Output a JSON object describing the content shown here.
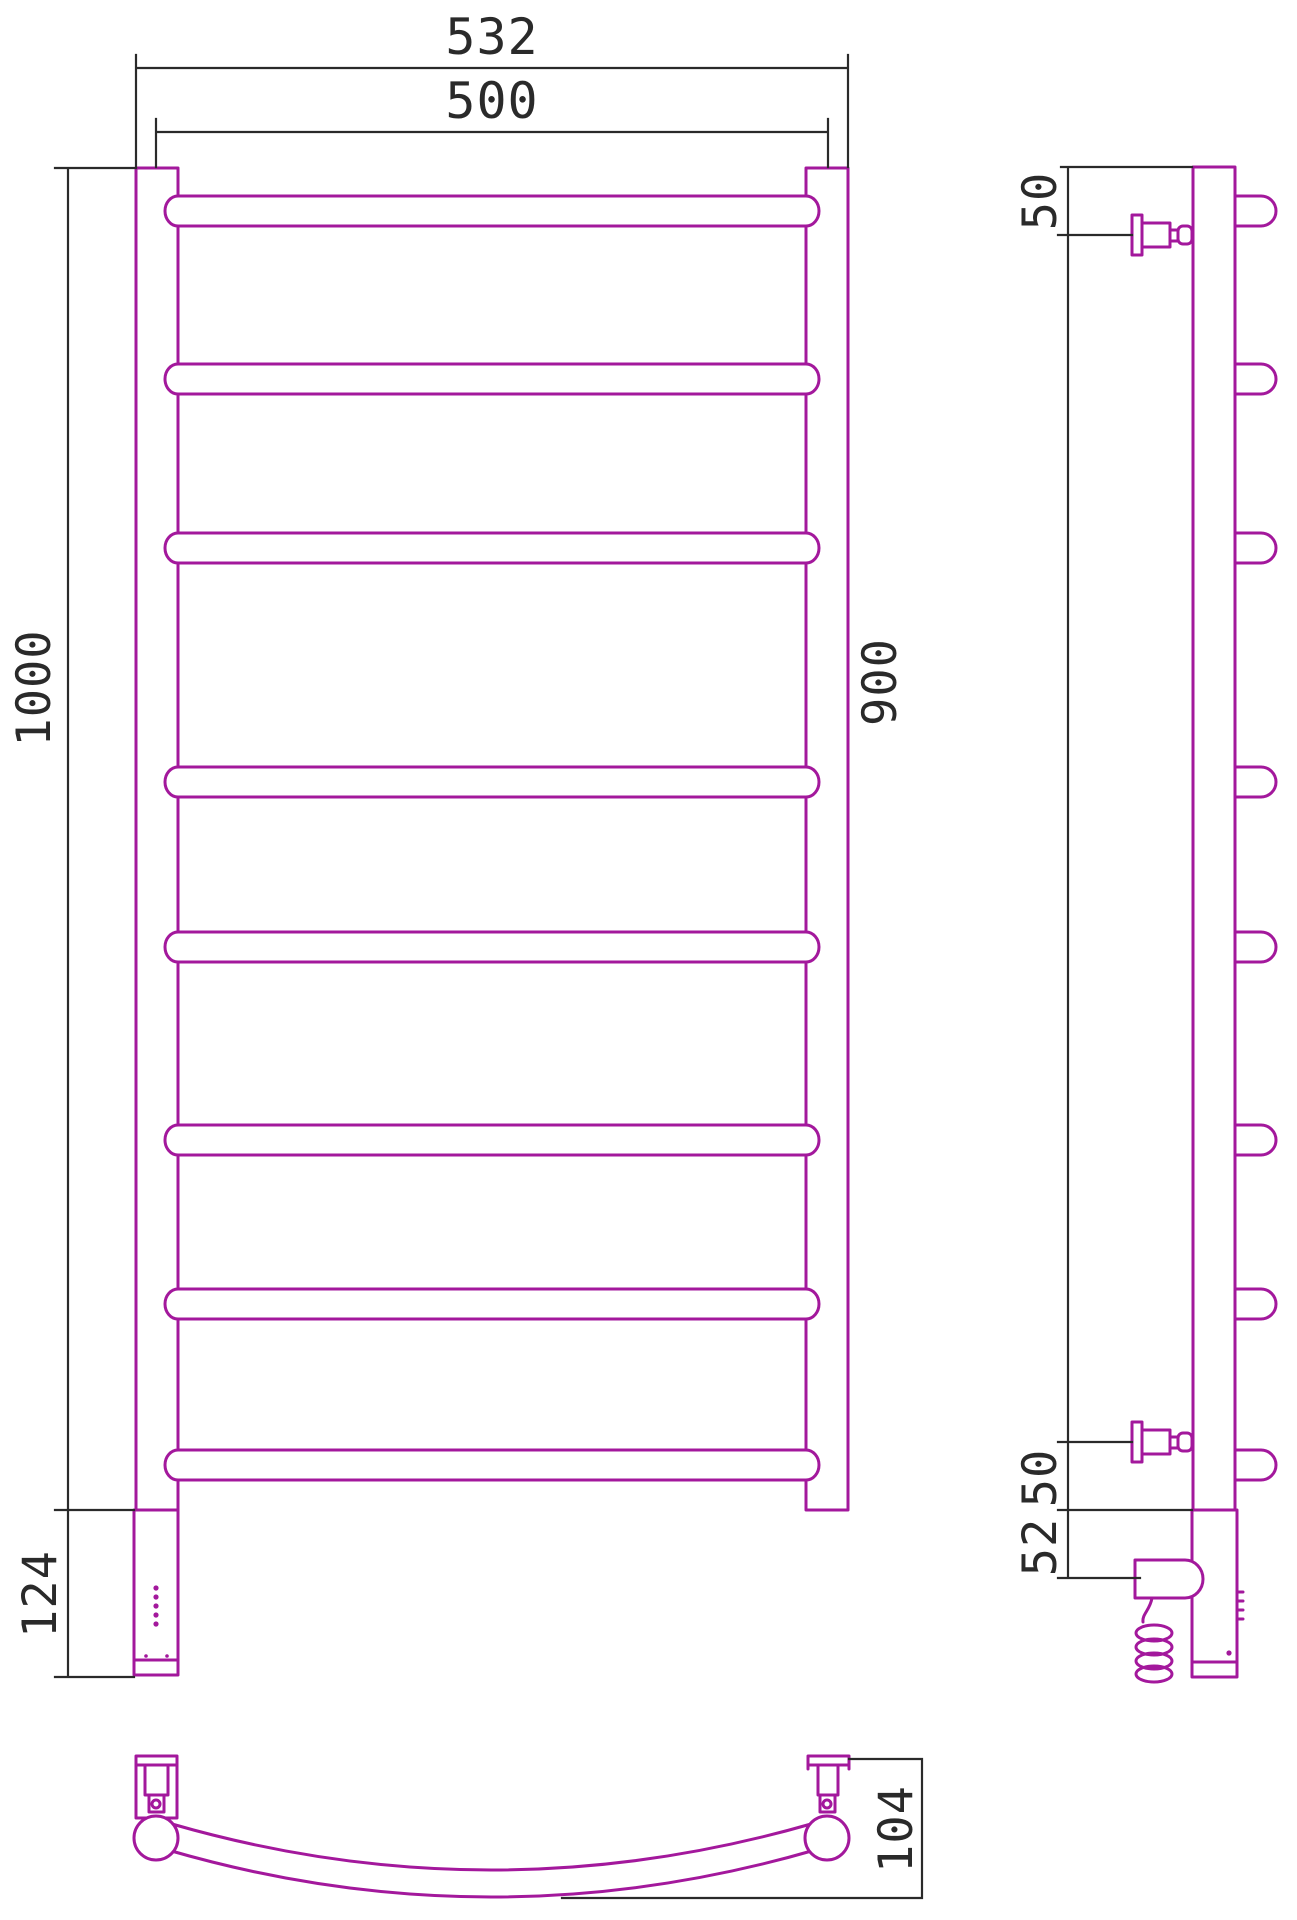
{
  "colors": {
    "outline": "#A3189C",
    "dims": "#2a2a2a"
  },
  "front_view": {
    "width_overall": "532",
    "width_centers": "500",
    "height": "1000",
    "housing_height": "124"
  },
  "side_view": {
    "top_offset": "50",
    "centers_height": "900",
    "bottom_offset": "50",
    "tail_height": "52"
  },
  "top_view": {
    "depth": "104"
  }
}
